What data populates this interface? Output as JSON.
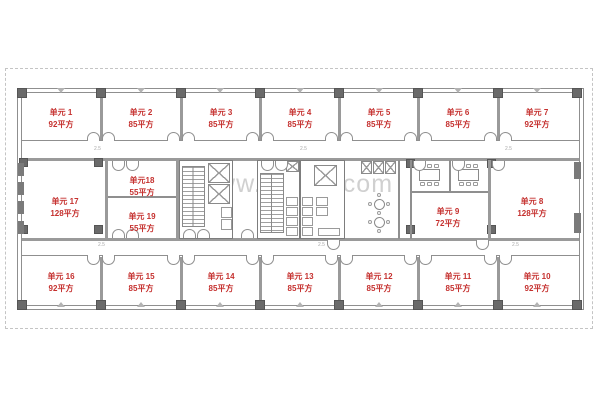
{
  "watermark": {
    "text": "www.01cbd.com",
    "color": "#cbcbcb"
  },
  "plan": {
    "dimension_mark": "2.5",
    "units": [
      {
        "name": "单元 1",
        "area": "92平方"
      },
      {
        "name": "单元 2",
        "area": "85平方"
      },
      {
        "name": "单元 3",
        "area": "85平方"
      },
      {
        "name": "单元 4",
        "area": "85平方"
      },
      {
        "name": "单元 5",
        "area": "85平方"
      },
      {
        "name": "单元 6",
        "area": "85平方"
      },
      {
        "name": "单元 7",
        "area": "92平方"
      },
      {
        "name": "单元 8",
        "area": "128平方"
      },
      {
        "name": "单元 9",
        "area": "72平方"
      },
      {
        "name": "单元 10",
        "area": "92平方"
      },
      {
        "name": "单元 11",
        "area": "85平方"
      },
      {
        "name": "单元 12",
        "area": "85平方"
      },
      {
        "name": "单元 13",
        "area": "85平方"
      },
      {
        "name": "单元 14",
        "area": "85平方"
      },
      {
        "name": "单元 15",
        "area": "85平方"
      },
      {
        "name": "单元 16",
        "area": "92平方"
      },
      {
        "name": "单元 17",
        "area": "128平方"
      },
      {
        "name": "单元18",
        "area": "55平方"
      },
      {
        "name": "单元 19",
        "area": "55平方"
      }
    ],
    "colors": {
      "unit_label": "#c5302e",
      "wall": "#8f8f8f",
      "column": "#6a6a6a"
    }
  }
}
